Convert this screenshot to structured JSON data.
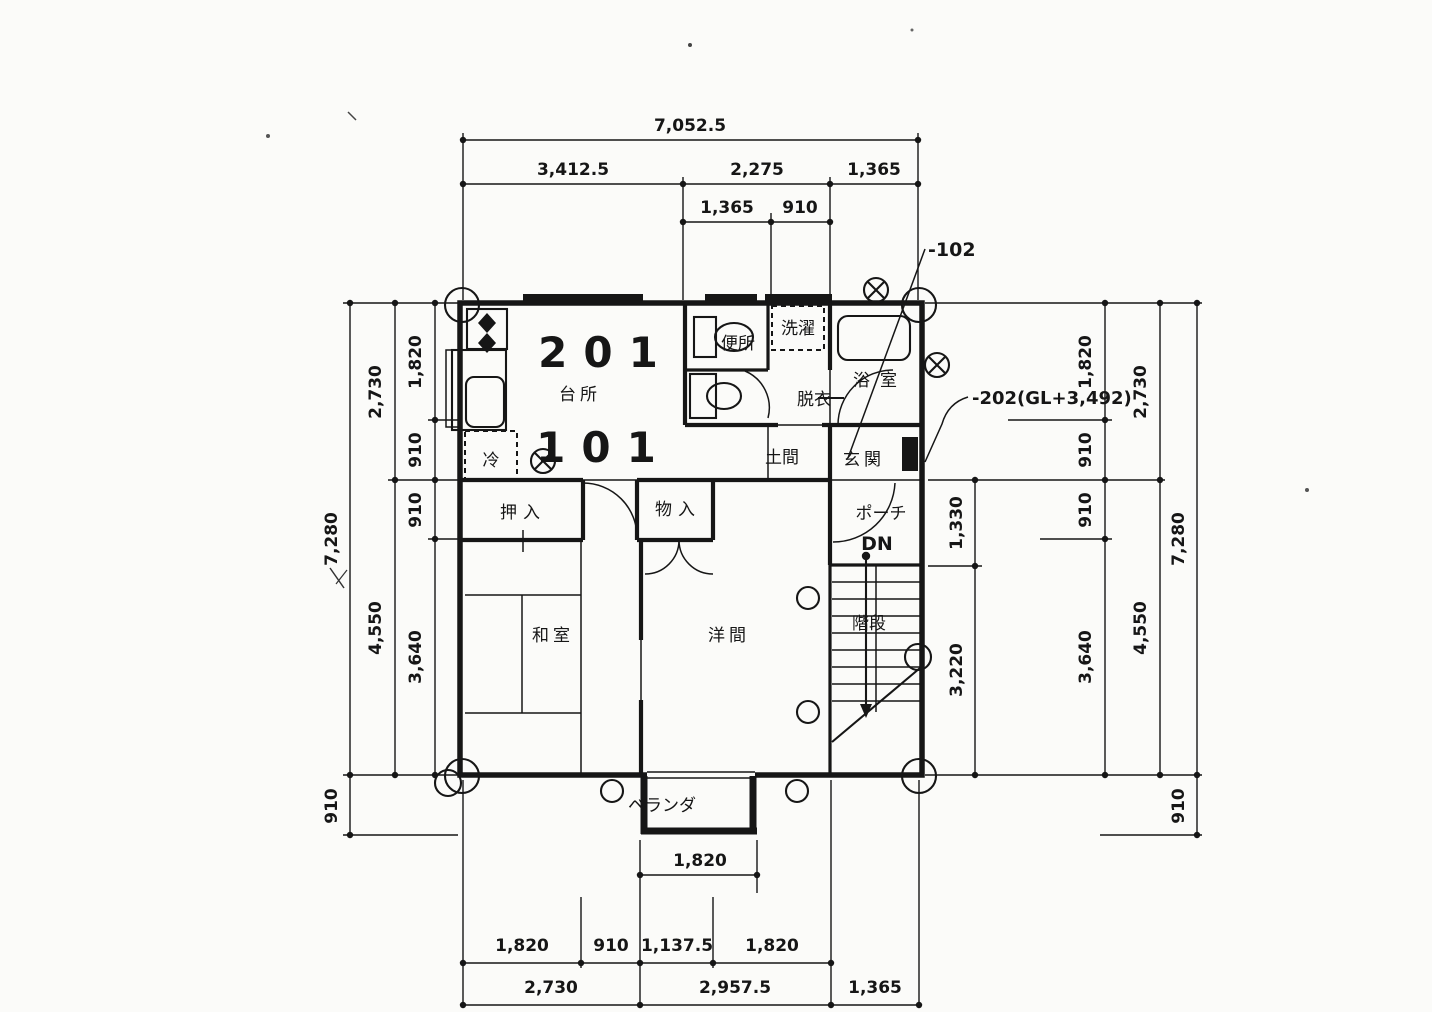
{
  "colors": {
    "ink": "#161616",
    "paper": "#fbfbf9"
  },
  "units": {
    "upper": "201",
    "lower": "101"
  },
  "rooms": {
    "kitchen": "台所",
    "closet": "押入",
    "storage": "物入",
    "japanese_room": "和室",
    "western_room": "洋間",
    "toilet": "便所",
    "laundry": "洗濯",
    "dressing": "脱衣",
    "bath": "浴室",
    "entrance": "玄関",
    "doma": "土間",
    "porch": "ポーチ",
    "down": "DN",
    "stairs": "階段",
    "veranda": "ベランダ",
    "fridge": "冷"
  },
  "annotations": {
    "ref_102": "-102",
    "ref_202": "-202(GL+3,492)"
  },
  "dims": {
    "top": {
      "total": "7,052.5",
      "row2": [
        "3,412.5",
        "2,275",
        "1,365"
      ],
      "row3": [
        "1,365",
        "910"
      ]
    },
    "left": {
      "total": "7,280",
      "below": "910",
      "mid": [
        "2,730",
        "4,550"
      ],
      "inner": [
        "1,820",
        "910",
        "910",
        "3,640"
      ]
    },
    "right": {
      "total": "7,280",
      "below": "910",
      "mid": [
        "2,730",
        "4,550"
      ],
      "col2": [
        "1,820",
        "910",
        "910",
        "3,640"
      ],
      "inner": [
        "1,330",
        "3,220"
      ]
    },
    "bottom": {
      "veranda": "1,820",
      "row1": [
        "1,820",
        "910",
        "1,137.5",
        "1,820"
      ],
      "row2": [
        "2,730",
        "2,957.5",
        "1,365"
      ]
    }
  }
}
